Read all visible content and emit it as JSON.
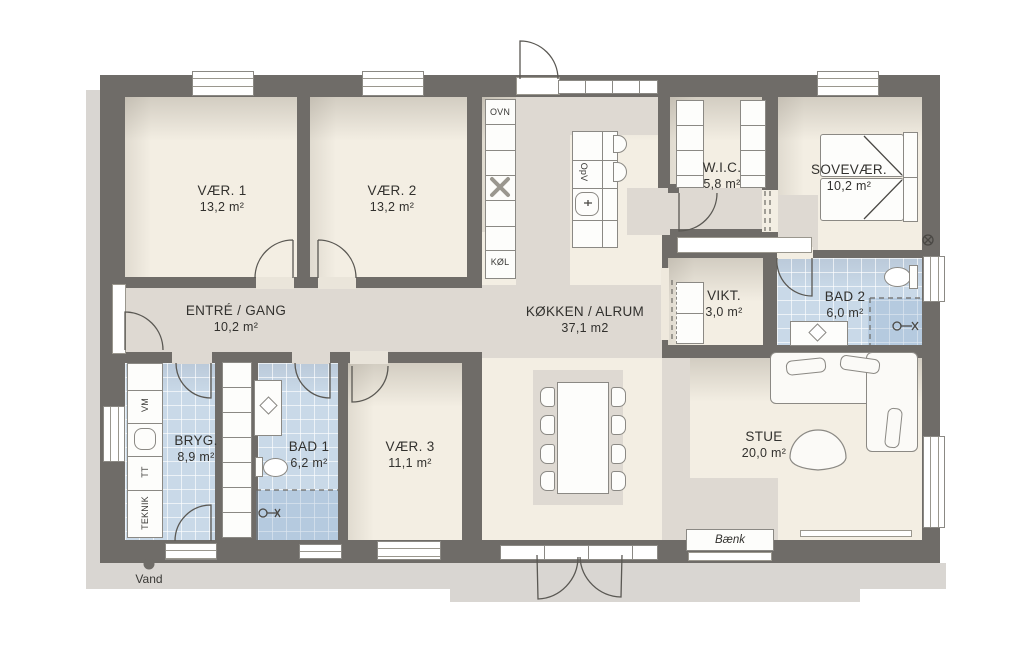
{
  "rooms": [
    {
      "id": "vaer1",
      "name": "VÆR. 1",
      "area": "13,2 m²"
    },
    {
      "id": "vaer2",
      "name": "VÆR. 2",
      "area": "13,2 m²"
    },
    {
      "id": "entre",
      "name": "ENTRÉ / GANG",
      "area": "10,2 m²"
    },
    {
      "id": "koekken",
      "name": "KØKKEN / ALRUM",
      "area": "37,1 m2"
    },
    {
      "id": "wic",
      "name": "W.I.C.",
      "area": "5,8 m²"
    },
    {
      "id": "sovevaer",
      "name": "SOVEVÆR.",
      "area": "10,2 m²"
    },
    {
      "id": "vikt",
      "name": "VIKT.",
      "area": "3,0 m²"
    },
    {
      "id": "bad2",
      "name": "BAD 2",
      "area": "6,0 m²"
    },
    {
      "id": "bryg",
      "name": "BRYG.",
      "area": "8,9 m²"
    },
    {
      "id": "bad1",
      "name": "BAD 1",
      "area": "6,2 m²"
    },
    {
      "id": "vaer3",
      "name": "VÆR. 3",
      "area": "11,1 m²"
    },
    {
      "id": "stue",
      "name": "STUE",
      "area": "20,0 m²"
    }
  ],
  "fixtures": {
    "ovn": "OVN",
    "koel": "KØL",
    "opv": "OpV",
    "vm": "VM",
    "tt": "TT",
    "teknik": "TEKNIK"
  },
  "annotations": {
    "bench": "Bænk",
    "water": "Vand",
    "outdoor_tap_symbol": "⊗"
  },
  "colors": {
    "wall": "#6f6c68",
    "floor_cream": "#f3eee3",
    "floor_gray": "#ded9d2",
    "tile_blue": "#c9d9e8",
    "fixture_white": "#fdfdfb",
    "outline": "#8b8984",
    "shadow": "#d9d6d2",
    "text": "#32312e"
  }
}
